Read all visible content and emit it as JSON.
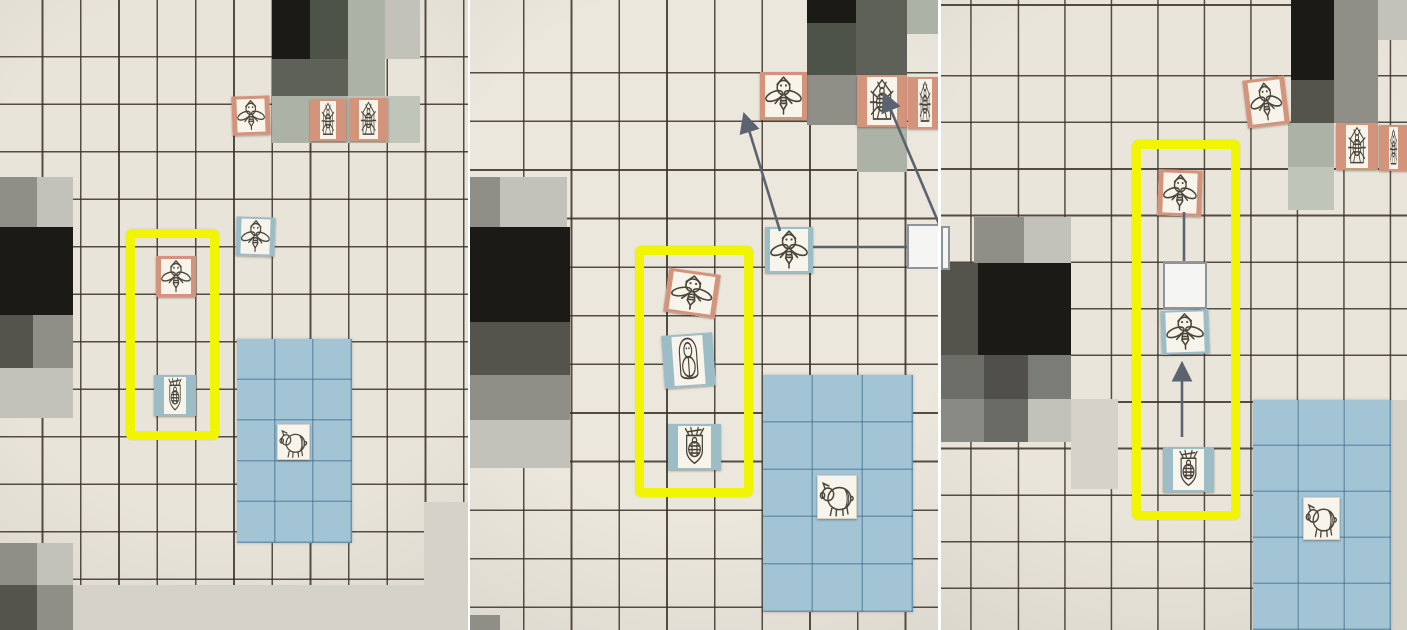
{
  "scene": {
    "description_name": "board-game-move-sequence-collage",
    "stage_w": 1407,
    "stage_h": 630
  },
  "colors": {
    "ink": "#4b4439",
    "grid_line": "rgba(58,50,40,0.85)",
    "zone_fill": "#a3c4d4",
    "zone_line": "rgba(55,100,135,0.5)",
    "arrow": "#5b6370",
    "highlight": "#f1f402",
    "orange_frame": "#d4937b",
    "blue_frame": "#9cbcc6",
    "black": "#1b1a17",
    "dark": "#55544c",
    "dark2": "#504f49",
    "darksage": "#4e5349",
    "darksage2": "#5d6157",
    "gray": "#8f8f88",
    "gray2": "#6e6e68",
    "gray3": "#7c7c76",
    "gray4": "#8a8a84",
    "gray5": "#6a6a64",
    "light": "#c3c2ba",
    "sagelight": "#adb2a6",
    "sagelight2": "#c0c5b9",
    "faint": "#d5d2c9"
  },
  "panels": [
    {
      "name": "board-photo-step-1",
      "x": 0,
      "w": 468,
      "paper": "#e9e4da",
      "grid": {
        "ox": 5,
        "oy": 10,
        "cw": 38.3,
        "ch": 47.5
      },
      "cells": [
        [
          272,
          0,
          38,
          59,
          "black"
        ],
        [
          310,
          0,
          38,
          59,
          "darksage"
        ],
        [
          272,
          59,
          76,
          37,
          "darksage2"
        ],
        [
          348,
          0,
          37,
          96,
          "sagelight"
        ],
        [
          385,
          0,
          35,
          59,
          "light"
        ],
        [
          272,
          96,
          76,
          47,
          "sagelight"
        ],
        [
          348,
          96,
          72,
          47,
          "sagelight2"
        ],
        [
          0,
          177,
          37,
          50,
          "gray"
        ],
        [
          37,
          177,
          36,
          50,
          "light"
        ],
        [
          0,
          227,
          73,
          88,
          "black"
        ],
        [
          0,
          315,
          33,
          53,
          "dark"
        ],
        [
          33,
          315,
          40,
          53,
          "gray"
        ],
        [
          0,
          368,
          73,
          50,
          "light"
        ],
        [
          0,
          543,
          37,
          42,
          "gray"
        ],
        [
          37,
          543,
          36,
          42,
          "light"
        ],
        [
          0,
          585,
          37,
          45,
          "dark"
        ],
        [
          37,
          585,
          36,
          45,
          "gray"
        ],
        [
          424,
          502,
          44,
          128,
          "faint"
        ],
        [
          73,
          585,
          351,
          45,
          "faint"
        ]
      ],
      "zone": {
        "x": 237,
        "y": 339,
        "w": 115,
        "h": 204,
        "cw": 38.3,
        "ch": 40.8
      },
      "tokens": [
        {
          "type": "wasp",
          "frame": "orange thin",
          "x": 232,
          "y": 96,
          "w": 38,
          "h": 39,
          "rot": -2
        },
        {
          "type": "beetle",
          "frame": "orange wide",
          "x": 310,
          "y": 99,
          "w": 36,
          "h": 42,
          "rot": 0
        },
        {
          "type": "beetle",
          "frame": "orange wide",
          "x": 349,
          "y": 98,
          "w": 39,
          "h": 43,
          "rot": 0
        },
        {
          "type": "wasp",
          "frame": "blue thin",
          "x": 236,
          "y": 217,
          "w": 39,
          "h": 39,
          "rot": 2
        },
        {
          "type": "wasp",
          "frame": "orange thin",
          "x": 156,
          "y": 256,
          "w": 40,
          "h": 41,
          "rot": 0
        },
        {
          "type": "queen",
          "frame": "blue wide",
          "x": 154,
          "y": 375,
          "w": 42,
          "h": 41,
          "rot": 0
        },
        {
          "type": "pig",
          "frame": "plain",
          "x": 277,
          "y": 424,
          "w": 33,
          "h": 36,
          "rot": 0
        }
      ],
      "white_squares": [],
      "highlight": {
        "x": 126,
        "y": 229,
        "w": 93,
        "h": 211
      },
      "arrows": []
    },
    {
      "name": "board-photo-step-2",
      "x": 470,
      "w": 468,
      "paper": "#ebe7dd",
      "grid": {
        "ox": 7,
        "oy": 25,
        "cw": 47.7,
        "ch": 48.6
      },
      "cells": [
        [
          337,
          0,
          49,
          23,
          "black"
        ],
        [
          337,
          23,
          49,
          52,
          "darksage"
        ],
        [
          386,
          0,
          51,
          75,
          "darksage2"
        ],
        [
          437,
          0,
          31,
          34,
          "sagelight"
        ],
        [
          337,
          75,
          50,
          50,
          "gray"
        ],
        [
          387,
          127,
          50,
          45,
          "sagelight"
        ],
        [
          0,
          177,
          30,
          50,
          "gray"
        ],
        [
          30,
          177,
          67,
          50,
          "light"
        ],
        [
          0,
          227,
          100,
          95,
          "black"
        ],
        [
          0,
          322,
          100,
          53,
          "dark"
        ],
        [
          0,
          375,
          100,
          45,
          "gray"
        ],
        [
          0,
          420,
          100,
          48,
          "light"
        ],
        [
          0,
          615,
          30,
          15,
          "gray"
        ]
      ],
      "zone": {
        "x": 293,
        "y": 375,
        "w": 150,
        "h": 237,
        "cw": 50,
        "ch": 47.4
      },
      "tokens": [
        {
          "type": "wasp",
          "frame": "orange thin",
          "x": 290,
          "y": 72,
          "w": 47,
          "h": 48,
          "rot": 0
        },
        {
          "type": "beetle",
          "frame": "orange wide",
          "x": 387,
          "y": 75,
          "w": 50,
          "h": 52,
          "rot": 0
        },
        {
          "type": "beetle",
          "frame": "orange wide",
          "x": 438,
          "y": 77,
          "w": 34,
          "h": 52,
          "rot": 0
        },
        {
          "type": "wasp",
          "frame": "blue thin",
          "x": 295,
          "y": 227,
          "w": 48,
          "h": 46,
          "rot": 0
        },
        {
          "type": "wasp",
          "frame": "orange thin",
          "x": 196,
          "y": 271,
          "w": 52,
          "h": 44,
          "rot": 8
        },
        {
          "type": "larva",
          "frame": "blue wide",
          "x": 193,
          "y": 334,
          "w": 51,
          "h": 53,
          "rot": -4
        },
        {
          "type": "queen",
          "frame": "blue wide",
          "x": 198,
          "y": 424,
          "w": 53,
          "h": 46,
          "rot": 0
        },
        {
          "type": "pig",
          "frame": "plain",
          "x": 347,
          "y": 475,
          "w": 40,
          "h": 44,
          "rot": 0
        }
      ],
      "white_squares": [
        [
          437,
          224,
          39,
          45
        ]
      ],
      "highlight": {
        "x": 165,
        "y": 246,
        "w": 118,
        "h": 251
      },
      "arrows": [
        {
          "x1": 310,
          "y1": 231,
          "x2": 275,
          "y2": 117,
          "head": true
        },
        {
          "x1": 469,
          "y1": 224,
          "x2": 415,
          "y2": 96,
          "head": true
        },
        {
          "x1": 343,
          "y1": 247,
          "x2": 437,
          "y2": 247,
          "head": false
        }
      ]
    },
    {
      "name": "board-photo-step-3",
      "x": 941,
      "w": 466,
      "paper": "#e9e5da",
      "grid": {
        "ox": 31.7,
        "oy": 30,
        "cw": 46.5,
        "ch": 46.6
      },
      "cells": [
        [
          350,
          0,
          43,
          80,
          "black"
        ],
        [
          393,
          0,
          44,
          80,
          "gray"
        ],
        [
          437,
          0,
          29,
          40,
          "light"
        ],
        [
          350,
          80,
          43,
          43,
          "dark"
        ],
        [
          393,
          80,
          44,
          43,
          "gray"
        ],
        [
          347,
          123,
          46,
          44,
          "sagelight"
        ],
        [
          347,
          167,
          46,
          43,
          "sagelight2"
        ],
        [
          33,
          217,
          50,
          46,
          "gray"
        ],
        [
          83,
          217,
          47,
          46,
          "light"
        ],
        [
          0,
          263,
          37,
          92,
          "dark"
        ],
        [
          37,
          263,
          93,
          92,
          "black"
        ],
        [
          0,
          355,
          43,
          44,
          "gray2"
        ],
        [
          43,
          355,
          44,
          44,
          "dark2"
        ],
        [
          87,
          355,
          43,
          44,
          "gray3"
        ],
        [
          0,
          399,
          43,
          43,
          "gray4"
        ],
        [
          43,
          399,
          44,
          43,
          "gray5"
        ],
        [
          87,
          399,
          43,
          43,
          "light"
        ],
        [
          130,
          399,
          47,
          90,
          "faint"
        ],
        [
          450,
          400,
          16,
          230,
          "faint"
        ]
      ],
      "zone": {
        "x": 312,
        "y": 400,
        "w": 138,
        "h": 230,
        "cw": 46,
        "ch": 46
      },
      "tokens": [
        {
          "type": "wasp",
          "frame": "orange thin",
          "x": 304,
          "y": 78,
          "w": 42,
          "h": 48,
          "rot": -7
        },
        {
          "type": "beetle",
          "frame": "orange wide",
          "x": 395,
          "y": 123,
          "w": 42,
          "h": 47,
          "rot": 0
        },
        {
          "type": "beetle",
          "frame": "orange wide",
          "x": 438,
          "y": 125,
          "w": 29,
          "h": 46,
          "rot": 0
        },
        {
          "type": "wasp",
          "frame": "orange thin",
          "x": 217,
          "y": 170,
          "w": 44,
          "h": 46,
          "rot": 2
        },
        {
          "type": "wasp",
          "frame": "blue thin",
          "x": 220,
          "y": 310,
          "w": 48,
          "h": 44,
          "rot": -2
        },
        {
          "type": "queen",
          "frame": "blue wide",
          "x": 222,
          "y": 447,
          "w": 51,
          "h": 45,
          "rot": 0
        },
        {
          "type": "pig",
          "frame": "plain",
          "x": 362,
          "y": 497,
          "w": 37,
          "h": 43,
          "rot": 0
        }
      ],
      "white_squares": [
        [
          0,
          226,
          9,
          44
        ],
        [
          222,
          262,
          44,
          47
        ]
      ],
      "highlight": {
        "x": 191,
        "y": 140,
        "w": 108,
        "h": 380
      },
      "arrows": [
        {
          "x1": 243,
          "y1": 212,
          "x2": 243,
          "y2": 261,
          "head": false
        },
        {
          "x1": 241,
          "y1": 437,
          "x2": 241,
          "y2": 366,
          "head": true
        }
      ]
    }
  ]
}
